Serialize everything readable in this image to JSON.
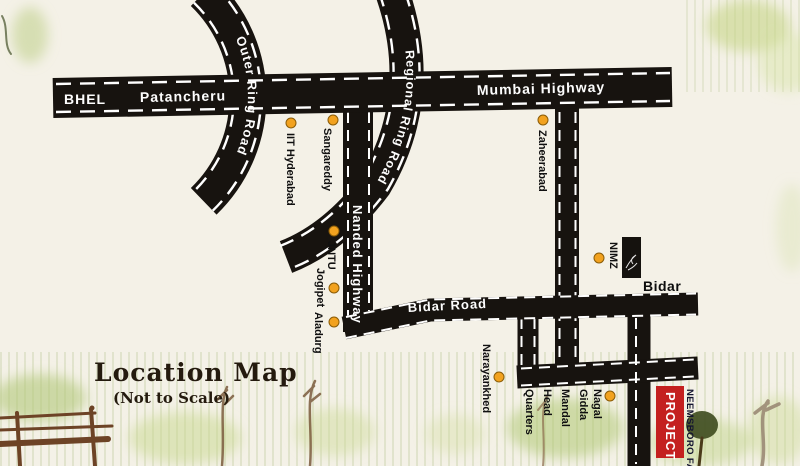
{
  "title": {
    "text": "Location Map",
    "note": "(Not to Scale)"
  },
  "roads": {
    "mumbai_highway": "Mumbai Highway",
    "outer_ring": "Outer Ring Road",
    "regional_ring": "Regional Ring Road",
    "nanded_highway": "Nanded Highway",
    "bidar_road": "Bidar Road"
  },
  "on_highway": {
    "bhel": "BHEL",
    "patancheru": "Patancheru"
  },
  "places": [
    {
      "name": "IIT Hyderabad"
    },
    {
      "name": "Sangareddy"
    },
    {
      "name": "Zaheerabad"
    },
    {
      "name": "JNTU"
    },
    {
      "name": "Jogipet"
    },
    {
      "name": "Aladurg"
    },
    {
      "name": "NIMZ"
    },
    {
      "name": "Narayankhed"
    }
  ],
  "mandal_hq": {
    "word1": "Nagal",
    "word2": "Gidda",
    "word3": "Mandal",
    "word4": "Head",
    "word5": "Quarters"
  },
  "city": {
    "name": "Bidar"
  },
  "project": {
    "tag": "PROJECT",
    "name": "NEEMSBORO FARM"
  },
  "colors": {
    "paper": "#f4f1e7",
    "road": "#17130f",
    "dash": "#ffffff",
    "marker_fill": "#f2a21f",
    "marker_edge": "#8a5c08",
    "project_red": "#c4201f"
  }
}
